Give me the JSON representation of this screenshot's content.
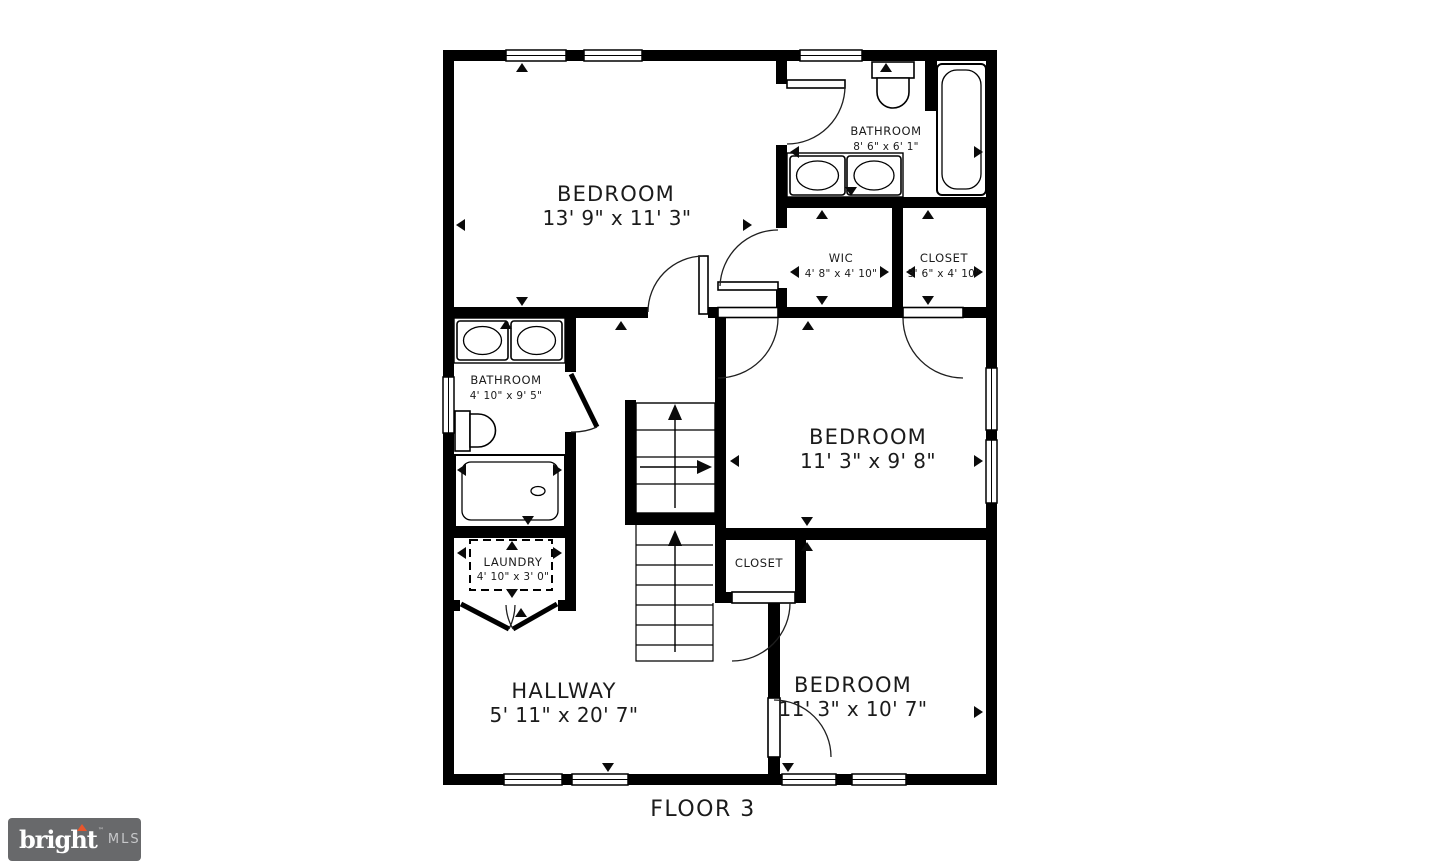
{
  "floor_plan": {
    "caption": "FLOOR 3",
    "rooms": [
      {
        "name": "BEDROOM",
        "dims": "13' 9\" x 11' 3\""
      },
      {
        "name": "BATHROOM",
        "dims": "8' 6\" x 6' 1\""
      },
      {
        "name": "WIC",
        "dims": "4' 8\" x 4' 10\""
      },
      {
        "name": "CLOSET",
        "dims": "3' 6\" x 4' 10\""
      },
      {
        "name": "BATHROOM",
        "dims": "4' 10\" x 9' 5\""
      },
      {
        "name": "BEDROOM",
        "dims": "11' 3\" x 9' 8\""
      },
      {
        "name": "LAUNDRY",
        "dims": "4' 10\" x 3' 0\""
      },
      {
        "name": "CLOSET",
        "dims": ""
      },
      {
        "name": "HALLWAY",
        "dims": "5' 11\" x 20' 7\""
      },
      {
        "name": "BEDROOM",
        "dims": "11' 3\" x 10' 7\""
      }
    ],
    "fixtures": [
      "toilet",
      "bathtub",
      "double-sink-vanity",
      "toilet",
      "shower",
      "double-sink-vanity",
      "staircase-up",
      "laundry-hookup"
    ],
    "colors": {
      "background": "#ffffff",
      "walls": "#000000",
      "labels": "#1b1b1b"
    }
  },
  "logo": {
    "brand": "bright",
    "trademark": "™",
    "suffix": "MLS",
    "colors": {
      "background": "#68696b",
      "brand_text": "#ffffff",
      "suffix_text": "#c7c8ca",
      "accent": "#e8562c"
    }
  }
}
